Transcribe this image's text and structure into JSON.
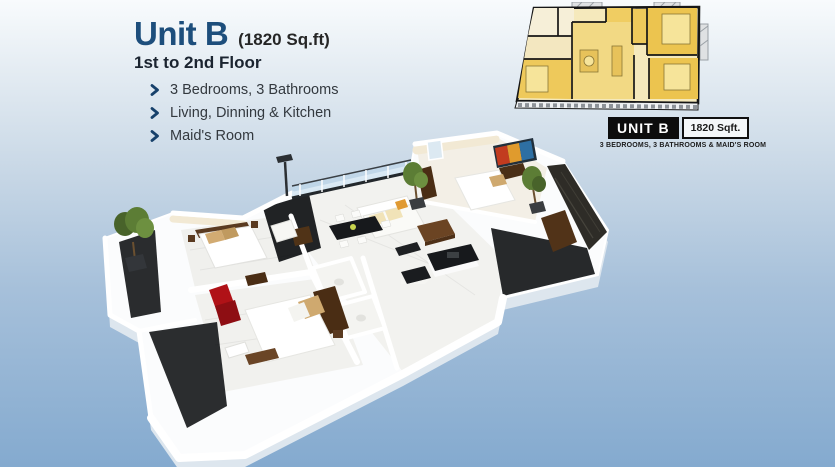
{
  "page": {
    "background_top": "#f8fbfd",
    "background_bottom": "#84aacf"
  },
  "header": {
    "title": "Unit B",
    "area": "(1820 Sq.ft)",
    "floor_range": "1st to 2nd Floor",
    "title_color": "#1d4e7c",
    "bullet_icon": "chevron-right",
    "features": [
      "3 Bedrooms, 3 Bathrooms",
      "Living, Dinning & Kitchen",
      "Maid's Room"
    ]
  },
  "plan2d": {
    "unit_badge": "UNIT B",
    "area_badge": "1820 Sqft.",
    "caption": "3 BEDROOMS, 3 BATHROOMS & MAID'S ROOM",
    "colors": {
      "room_gold": "#eec95b",
      "room_deep": "#ecc44f",
      "room_light": "#f5e9bc",
      "room_cream": "#f6efd8",
      "wall": "#161616"
    }
  },
  "plan3d": {
    "colors": {
      "slab": "#fbfcfd",
      "slab_shadow": "#dde6ee",
      "marble": "#f0f0ed",
      "cream_wall": "#f2e9d4",
      "terrace_dark": "#2a2c2e",
      "wood": "#5a3a20",
      "chair_red": "#b01217",
      "plant": "#5c7d35",
      "glass": "#bcd7eb",
      "counter_dark": "#17191c",
      "stone_wall": "#2e2c27"
    }
  }
}
